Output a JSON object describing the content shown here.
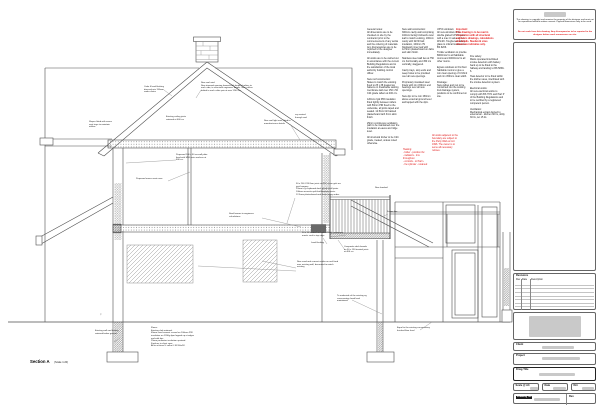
{
  "section": {
    "name": "Section A",
    "scale": "(Scale 1:20)"
  },
  "colors": {
    "red_note": "#e01818",
    "line": "#4d4d4d",
    "hatch": "#9a9a9a"
  },
  "notes": {
    "col1": "General notes:\nAll dimensions are to be checked on site by the contractor prior to the commencement of any works and the ordering of materials. Any discrepancies are to be reported to the designer immediately.\n\nAll works are to be carried out in accordance with the current Building Regulations and to the satisfaction of the local authority building control officer.\n\nNew roof construction:\nSlates to match the existing fixed to 25 x 38 treated sw battens on breathable sarking membrane laid over 150 x 50 C24 grade rafters at 400 crs.\n\n120mm rigid PIR insulation fitted tightly between rafters with 50mm PIR fixed to the underside, all joints taped and sealed. 12.5mm foil backed plasterboard with 3mm skim finish.\n\n25mm continuous ventilation path to be maintained over the insulation at eaves and ridge level.\n\nAll structural timber to be C24 grade, treated, unless noted otherwise.",
    "col2": "New wall construction:\n300mm cavity wall comprising 102mm facing brickwork outer leaf to match existing, 100mm cavity with full fill batt insulation, 100mm 7N blockwork inner leaf with 12.5mm plasterboard on dabs and skim finish.\n\nStainless steel wall ties at 750 crs horizontally and 450 crs vertically, staggered.\n\nCavity trays, stop ends and weep holes to be provided over all new openings.\n\nProprietary insulated steel lintels with min 150mm end bearings over all new openings.\n\nNew dpc to be min 150mm above external ground level and lapped with the dpm.",
    "col3": "UPVC windows:\nAll new windows to be double glazed UPVC units with a max U value of 1.4 W/m2K. Toughened safety glass to critical locations to BS 6206.\n\nTrickle ventilation to provide 8000mm2 to all habitable rooms and 4000mm2 to all other rooms.\n\nEgress windows to first floor habitable rooms to give a min clear opening of 0.33m2 and min 450mm clear width.\n\nDrainage:\nNew gullies and svp to be connected into the existing foul drainage system, positions to be confirmed on site.",
    "col4": "Fire safety:\nMains operated interlinked smoke detectors with battery back up to be fitted to the hallway and landing to BS 5839-6.\n\nHeat detector to be fitted within the kitchen area, interlinked with the smoke detection system.\n\nElectrical works:\nAll new electrical works to comply with BS 7671 and Part P of the Building Regulations and to be certified by a registered competent person.\n\nVentilation:\nMechanical extract ducted to external air - kitchen 60 l/s, utility 30 l/s, wc 15 l/s.",
    "red_top": "Important:\nThis drawing is to be read in conjunction with all structural engineers drawings, calculations and details. Steelwork sizes shown are indicative only.",
    "red_mid": "All works adjacent to the boundary are subject to the Party Wall etc Act 1996. The owner is to serve all necessary notices.",
    "red_list": "Heating:\n- boiler - position tbc\n- radiators - trvs throughout\n- controls - to Part L\n- hw cylinder - retained"
  },
  "callouts": {
    "ridge_note": "New roof void:\nNew trimmed opening formed with doubled rafters to each side, to structural engineers details. New collars bolted to each rafter pair at max 1200 crs.",
    "flashing_note": "Code 4 lead flashing dressed min 150mm under slates",
    "gable_left": "Slopes fitted with eaves vent trays to maintain airflow",
    "trusses": "Existing ceiling joists retained at 400 crs",
    "rooflight": "New roof light over, fitted to manufacturers details",
    "vent_label": "svp vented through roof",
    "prop_plate": "Proposed 100 x 50 sw wall plate fixed with M10 resin anchors at 600 crs",
    "eaves_vents": "Proposed eaves vents over",
    "floor_joists": "50 x 200 C24 floor joists at 400 crs on galv ms joist hangers.\n22mm t+g chipboard deck glued at all joints.\n100mm acoustic quilt laid between joists.\n12.5mm plasterboard and skim ceiling under.",
    "steel_beam": "Steel beams to engineers calculations",
    "battens": "50 x 50 treated sw battens with continuous mastic seal to top edge",
    "render_note": "New sand and cement render on eml fixed over existing wall, decorated to match existing",
    "floors_spec": "Floors:\nExisting slab retained.\n65mm sand cement screed on 100mm PIR insulation on 1200g dpm lapped up at edges and with dpc.\n25mm perimeter insulation upstand.\nFinishes to client spec.\nAll to achieve U value 0.18 W/m2K.",
    "found_note": "Existing wall and footing retained below ground",
    "ground_marker": "▽",
    "deck_note": "Composite deck boards on 50 x 150 treated joists at 400 crs",
    "under_note": "To underside of the existing eg conservatory head level maintained",
    "handrail": "New handrail",
    "frame_line": "Frame line",
    "cons_floor": "Equal to the existing conservatory finished floor level",
    "flashing2": "Lead flashing"
  },
  "titleblock": {
    "disclaimer": "This drawing is copyright and remains the property of the designer and must not be reproduced without written consent. Figured dimensions only to be used.",
    "disclaimer_red": "Do not scale from this drawing. Any discrepancies to be reported to the designer before work commences on site.",
    "revisions_label": "Revisions",
    "rev_col_rev": "Rev",
    "rev_col_date": "Date",
    "rev_col_desc": "Description",
    "client_label": "Client",
    "project_label": "Project",
    "drwg_title_label": "Drwg Title",
    "scale_label": "Scale @ A3",
    "date_label": "Date",
    "drn_label": "Drn",
    "drawing_no_label": "Drawing No",
    "rev_label": "Rev"
  }
}
